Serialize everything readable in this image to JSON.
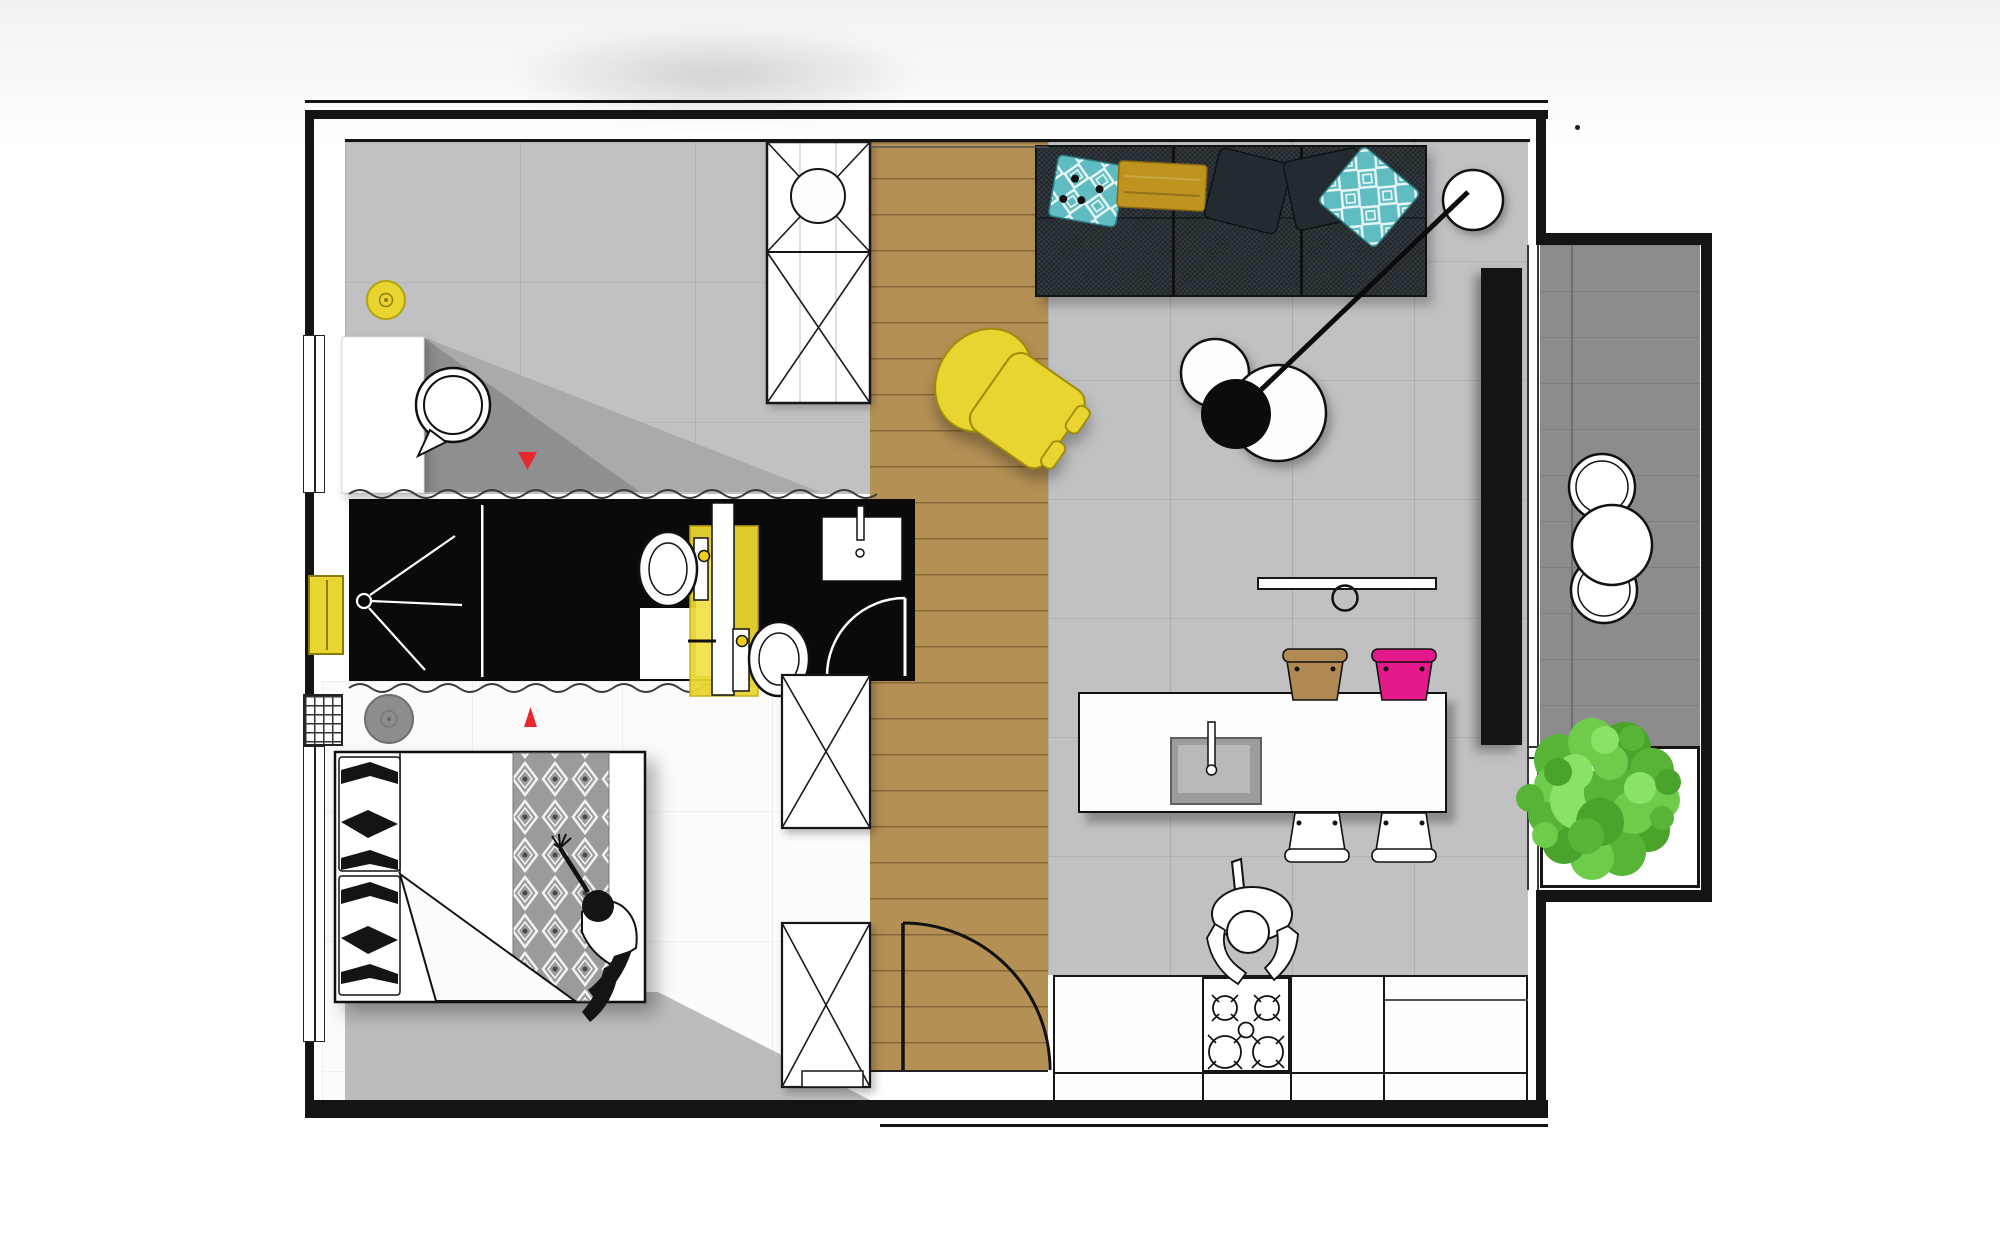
{
  "title": "Apartment floor plan, top-down view",
  "palette": {
    "wall": "#141414",
    "bathroom_black": "#0a0a0a",
    "wood_floor": "#b49055",
    "tile_floor": "#c1c1c3",
    "bedroom_floor": "#fbfbfb",
    "deck_gray": "#8c8c8e",
    "shadow_gray": "#bcbcbe",
    "sofa_dark": "#2a3237",
    "pillow_dark": "#232b30",
    "pillow_teal": "#5fbdc2",
    "pillow_mustard": "#bf9320",
    "accent_yellow": "#e9d52f",
    "accent_pink": "#e5188c",
    "stool_tan": "#b08a52",
    "marker_red": "#e8282d",
    "tree_green": "#57b437",
    "rug_gray": "#8d8d8d",
    "counter_white": "#fefefe"
  },
  "objects": [
    {
      "id": "studio-room",
      "label": "gray-tiled room with desk, shell chair and yellow pouf"
    },
    {
      "id": "wardrobe-washer",
      "label": "wardrobe column with washing machine"
    },
    {
      "id": "hallway",
      "label": "wooden-plank hallway with entrance door"
    },
    {
      "id": "bathroom",
      "label": "black bathroom with shower, two toilets, yellow unit and washbasin"
    },
    {
      "id": "bedroom",
      "label": "bedroom with double bed, patterned runner and seated person"
    },
    {
      "id": "living-room",
      "label": "living room with dark sofa, pillows, arc lamp, coffee table, yellow armchair"
    },
    {
      "id": "kitchen",
      "label": "kitchen island with bar stools, hob and cooking person"
    },
    {
      "id": "balcony",
      "label": "balcony with lounge circles and tree planter"
    }
  ]
}
